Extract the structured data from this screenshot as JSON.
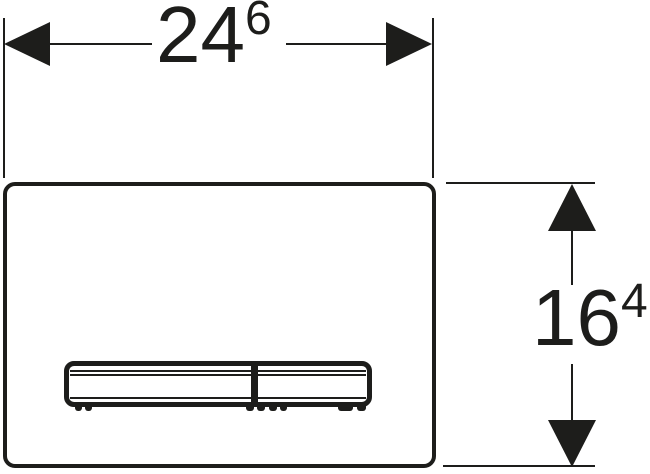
{
  "drawing": {
    "description": "Flush plate front view technical drawing with overall dimensions",
    "line_color": "#1d1d1b",
    "background_color": "#ffffff",
    "dimensions": {
      "width": {
        "value": "24",
        "superscript": "6"
      },
      "height": {
        "value": "16",
        "superscript": "4"
      }
    },
    "icons": {
      "arrowheads": [
        "arrowhead-left-icon",
        "arrowhead-right-icon",
        "arrowhead-up-icon",
        "arrowhead-down-icon"
      ]
    }
  }
}
